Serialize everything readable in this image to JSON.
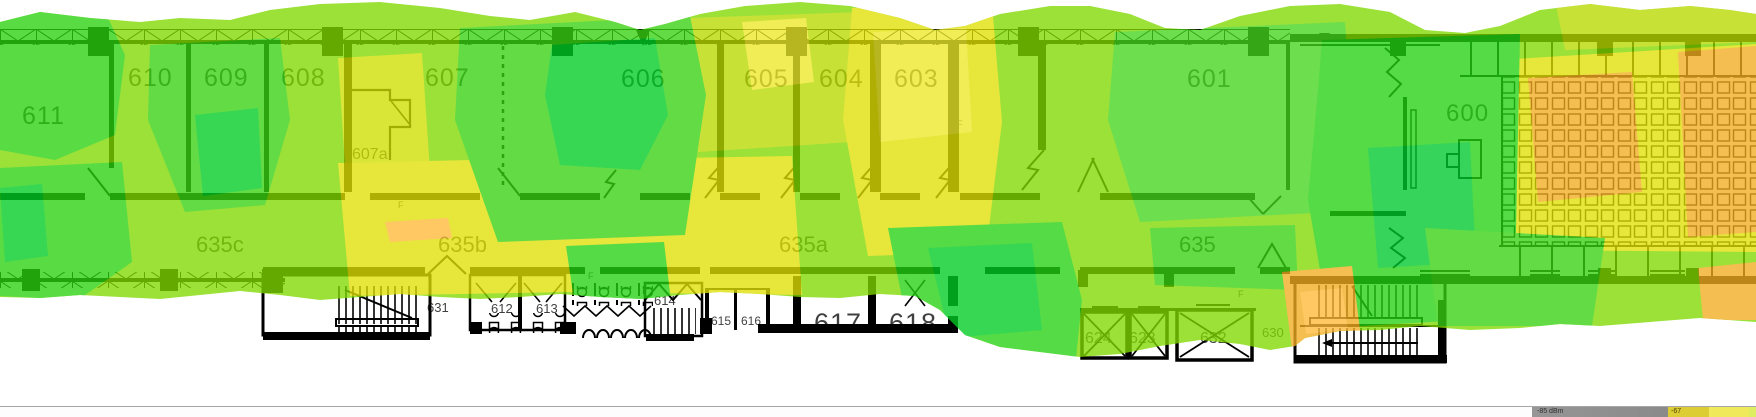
{
  "floor_plan": {
    "rooms": [
      {
        "label": "611"
      },
      {
        "label": "610"
      },
      {
        "label": "609"
      },
      {
        "label": "608"
      },
      {
        "label": "607"
      },
      {
        "label": "607a"
      },
      {
        "label": "606"
      },
      {
        "label": "605"
      },
      {
        "label": "604"
      },
      {
        "label": "603"
      },
      {
        "label": "601"
      },
      {
        "label": "600"
      },
      {
        "label": "635c"
      },
      {
        "label": "635b"
      },
      {
        "label": "635a"
      },
      {
        "label": "635"
      },
      {
        "label": "631"
      },
      {
        "label": "612"
      },
      {
        "label": "613"
      },
      {
        "label": "614"
      },
      {
        "label": "615"
      },
      {
        "label": "616"
      },
      {
        "label": "617"
      },
      {
        "label": "618"
      },
      {
        "label": "624"
      },
      {
        "label": "623"
      },
      {
        "label": "632"
      },
      {
        "label": "630"
      }
    ],
    "fire_marker": "F"
  },
  "heatmap": {
    "palette": {
      "strong": "#2fd755",
      "good": "#55dc46",
      "fair": "#9ce132",
      "weak": "#e6e63c",
      "poor": "#f5be50"
    }
  },
  "status_bar": {
    "legend": {
      "low_label": "-85 dBm",
      "threshold_label": "-67"
    }
  }
}
